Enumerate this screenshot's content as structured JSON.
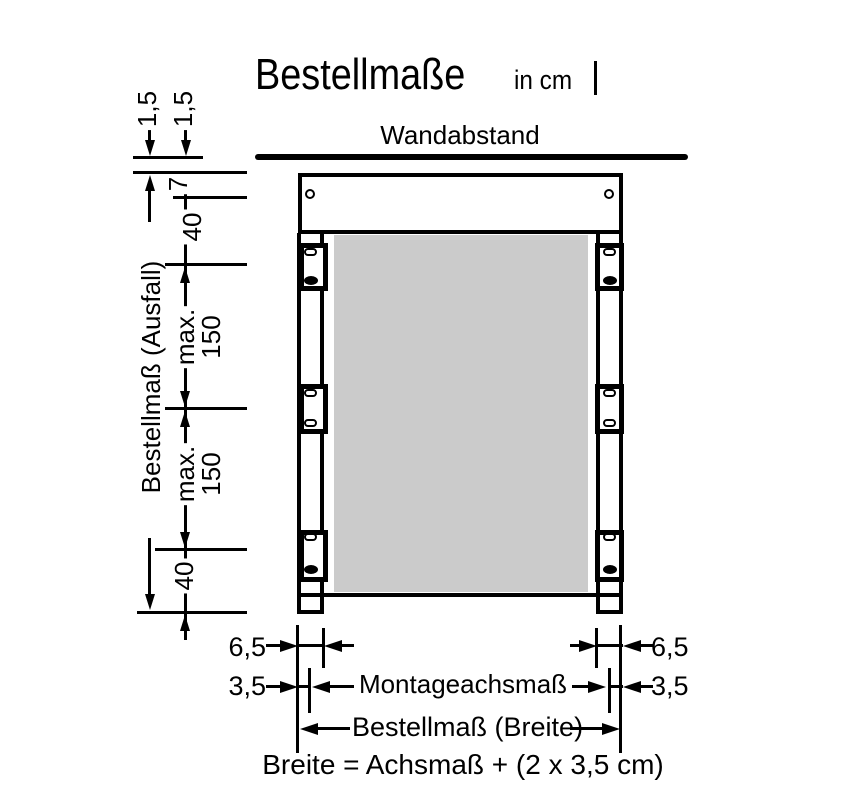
{
  "title": {
    "text": "Bestellmaße",
    "unit": "in cm"
  },
  "wall": {
    "label": "Wandabstand"
  },
  "dims_left": {
    "gap_wall": "1,5",
    "gap_profile": "1,5",
    "hole_offset": "7",
    "cassette_height": "40",
    "bracket_max_1": "max.\n150",
    "bracket_max_2": "max.\n150",
    "bottom_offset": "40",
    "ausfall_label": "Bestellmaß (Ausfall)"
  },
  "dims_bottom": {
    "rail_width_left": "6,5",
    "axis_offset_left": "3,5",
    "rail_width_right": "6,5",
    "axis_offset_right": "3,5",
    "axis_label": "Montageachsmaß",
    "width_label": "Bestellmaß (Breite)",
    "formula": "Breite = Achsmaß + (2 x 3,5 cm)"
  },
  "colors": {
    "ink": "#000000",
    "fabric": "#cbcbcb",
    "background": "#ffffff"
  }
}
